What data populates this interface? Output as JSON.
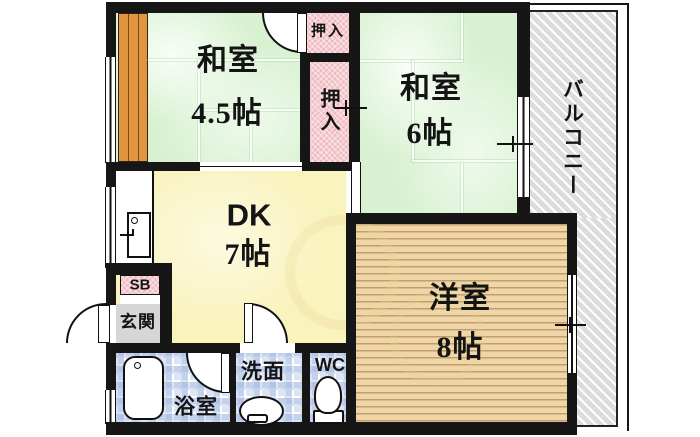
{
  "plan": {
    "title": "2DK floor plan",
    "rooms": {
      "washitsu45": {
        "label": "和室",
        "area": "4.5帖"
      },
      "washitsu6": {
        "label": "和室",
        "area": "6帖"
      },
      "dk": {
        "label": "DK",
        "area": "7帖"
      },
      "youshitsu": {
        "label": "洋室",
        "area": "8帖"
      },
      "balcony": {
        "label": "バルコニー"
      },
      "closet_upper": {
        "label": "押入"
      },
      "closet_lower": {
        "label": "押入"
      },
      "entrance": {
        "label": "玄関"
      },
      "shoebox": {
        "label": "SB"
      },
      "bathroom": {
        "label": "浴室"
      },
      "washroom": {
        "label": "洗面"
      },
      "toilet": {
        "label": "WC"
      }
    },
    "icons": {
      "bathtub": "bathtub-icon",
      "washbasin": "washbasin-icon",
      "toilet_bowl": "toilet-icon",
      "kitchen_sink": "kitchen-sink-icon"
    },
    "colors": {
      "wall": "#161616",
      "tatami_green": "#d8f2d1",
      "closet_pink": "#f5cdd2",
      "dk_yellow": "#f9f3bd",
      "wood_floor": "#eed6a8",
      "balcony_gray": "#dcdcdc",
      "tile_blue": "#dbe5f5",
      "entrance_gray": "#d6d6d6",
      "engawa_orange": "#e2953f"
    }
  }
}
